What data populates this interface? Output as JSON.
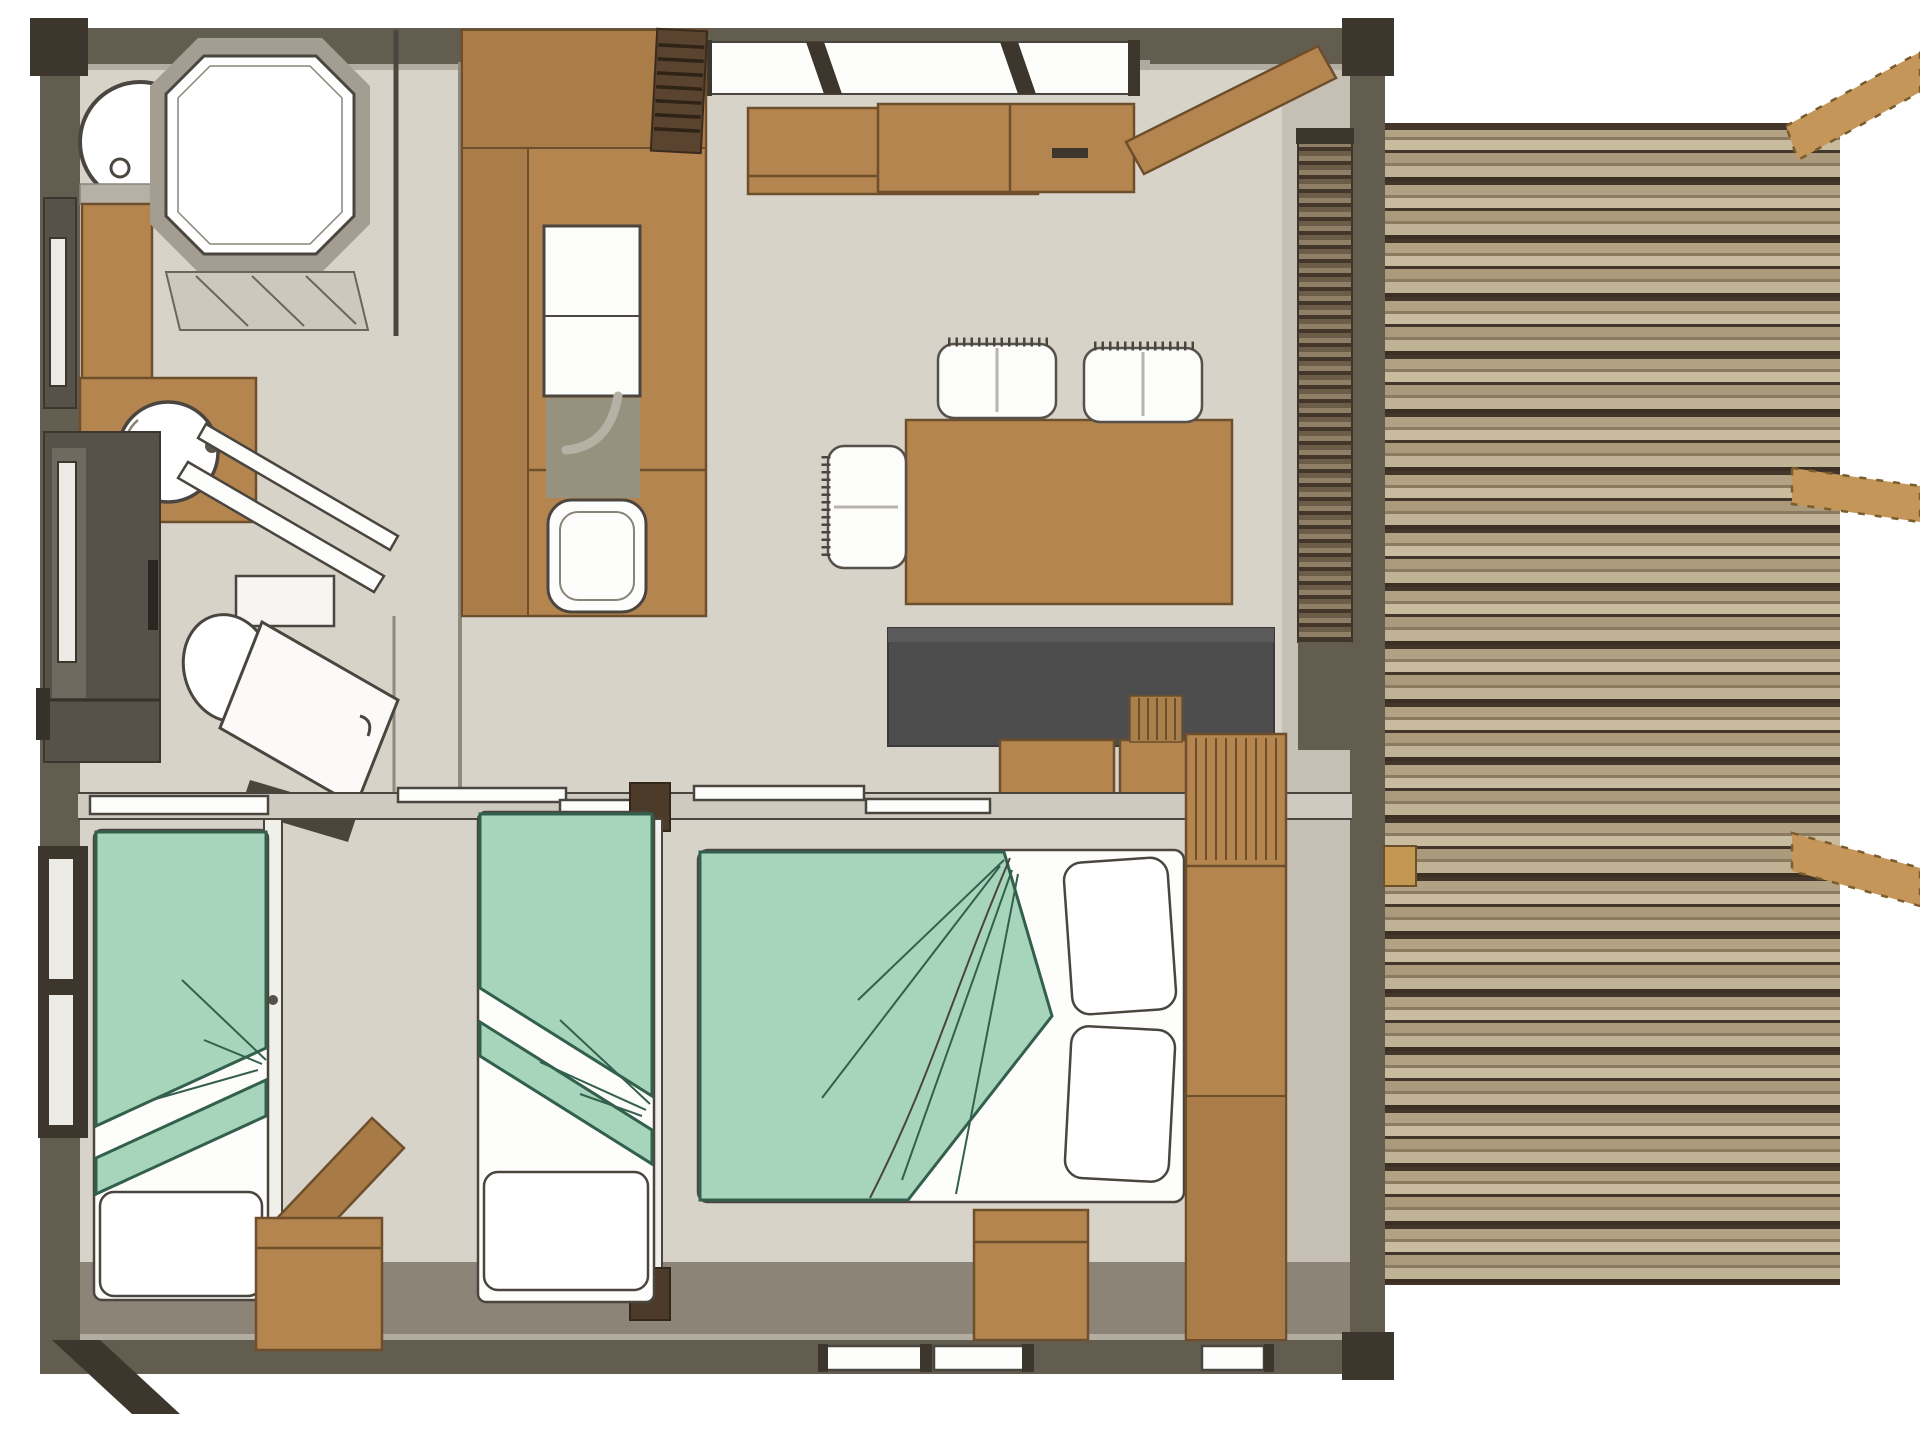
{
  "image_type": "architectural floor plan, top-down 3d render, no text labels",
  "palette": {
    "bg": "#ffffff",
    "floor": "#d8d3c9",
    "floor-shadow": "#8c8477",
    "wall": "#635d50",
    "wall-edge": "#b3ada1",
    "wall-darkest": "#3c362c",
    "outline": "#4a463f",
    "wood": "#b5854f",
    "wood-dark": "#6e4f2c",
    "wood-mid": "#aa7c47",
    "wood-light": "#c2974f",
    "beam": "#c49659",
    "beam-edge": "#7a5c2d",
    "deck-tan": "#b2a183",
    "deck-light": "#c9bc9e",
    "deck-mid": "#8a7a5f",
    "deck-dark": "#42372a",
    "duvet": "#a6d5bc",
    "duvet-line": "#33604d",
    "white": "#fdfdfb",
    "sofa": "#4d4d4d",
    "cab-dark": "#56524a",
    "cab-panel": "#6e6a60",
    "glass": "#eceae5",
    "gray-item": "#97917f"
  },
  "scene": {
    "rooms": [
      {
        "name": "bathroom",
        "furniture": [
          "shower-cabin",
          "water-heater",
          "vanity-round-basin",
          "wall-window"
        ]
      },
      {
        "name": "wc",
        "furniture": [
          "toilet",
          "open-door-panel",
          "towel-rails",
          "tall-dark-wardrobe"
        ]
      },
      {
        "name": "kitchen",
        "furniture": [
          "counter-block",
          "sink-with-faucet",
          "cooktop"
        ]
      },
      {
        "name": "living-dining",
        "furniture": [
          "wall-shelf",
          "window-band",
          "dining-table",
          "three-white-chairs",
          "dark-sofa",
          "sideboard-cabinets",
          "open-entrance-door"
        ]
      },
      {
        "name": "bedroom-single-left",
        "furniture": [
          "single-bed-green-duvet",
          "pillow"
        ]
      },
      {
        "name": "bedroom-single-middle",
        "furniture": [
          "single-bed-green-duvet",
          "pillow",
          "nightstand-open-lid"
        ]
      },
      {
        "name": "bedroom-double",
        "furniture": [
          "double-bed-green-duvet",
          "two-pillows",
          "tall-wardrobe",
          "foot-cabinet",
          "bottom-windows"
        ]
      },
      {
        "name": "deck-terrace",
        "furniture": [
          "plank-decking",
          "three-pergola-beams",
          "rolled-canvas-strip",
          "door-handle-block"
        ]
      }
    ]
  }
}
